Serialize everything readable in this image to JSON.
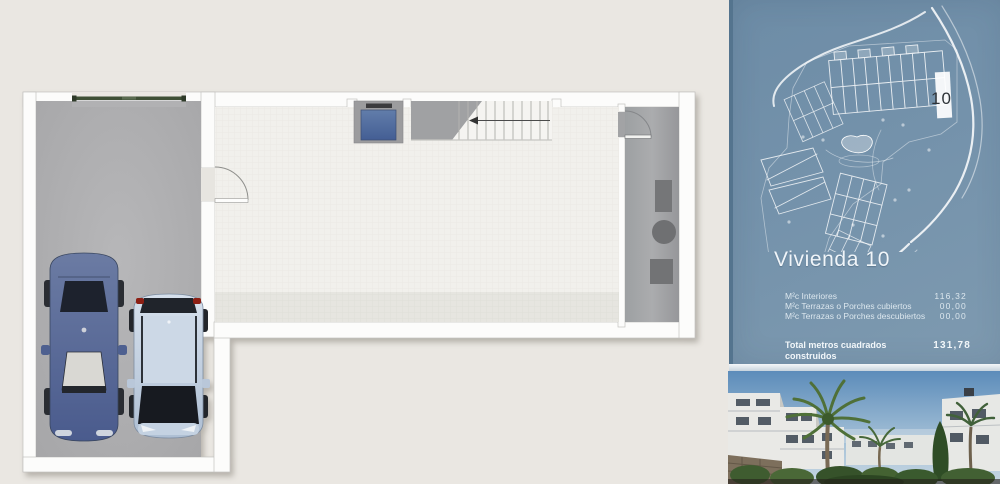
{
  "panel": {
    "title": "Vivienda 10",
    "site_plan": {
      "highlight_label": "10"
    },
    "area_rows": [
      {
        "label": "M²c Interiores",
        "value": "116,32"
      },
      {
        "label": "M²c Terrazas o Porches cubiertos",
        "value": "00,00"
      },
      {
        "label": "M²c Terrazas o Porches descubiertos",
        "value": "00,00"
      }
    ],
    "total_row": {
      "label": "Total metros cuadrados construidos",
      "value": "131,78"
    }
  },
  "colors": {
    "page_background": "#eae7e2",
    "panel_blue": "#7492ab",
    "plan_wall": "#fcfcfb",
    "garage_floor": "#b1b1b3",
    "main_floor": "#f1f0ec",
    "utility_floor": "#a6a7a9",
    "garage_door_green": "#3e4f35",
    "elevator_blue": "#5572a0",
    "car_dark_blue": "#55688f",
    "car_light_blue": "#c3d2e4"
  }
}
